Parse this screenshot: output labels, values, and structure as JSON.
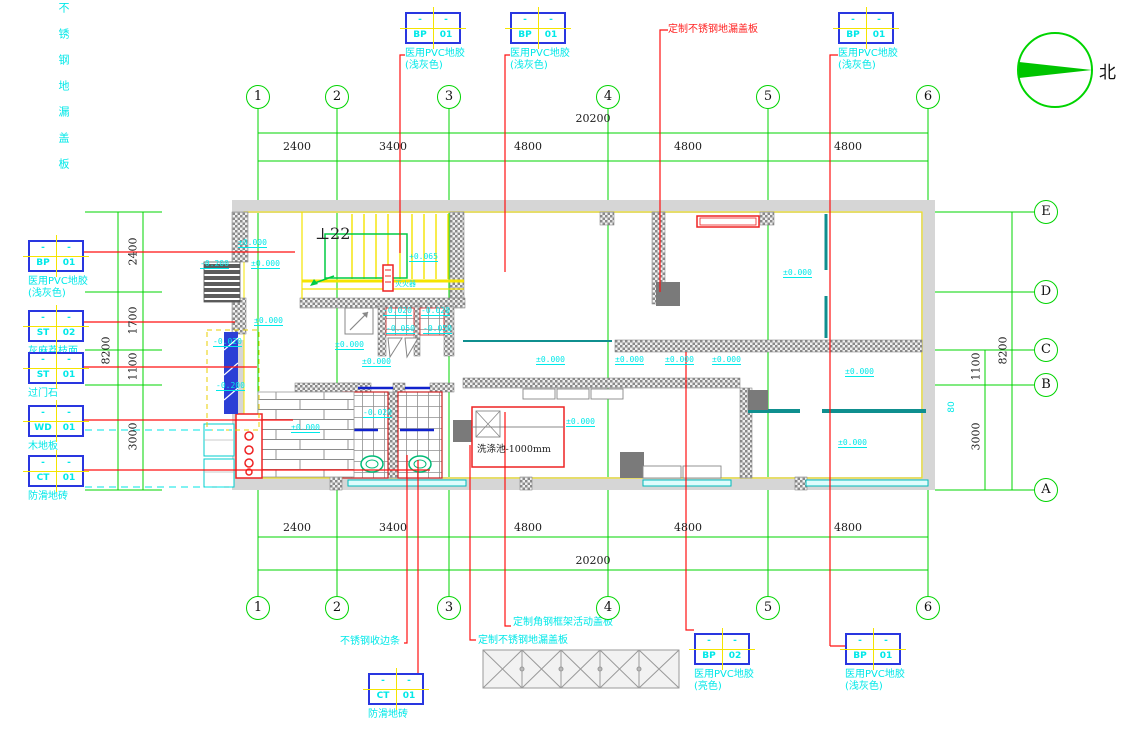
{
  "corner_note": "不锈钢地漏盖板",
  "north_label": "北",
  "grid": {
    "cols": [
      "1",
      "2",
      "3",
      "4",
      "5",
      "6"
    ],
    "rows": [
      "E",
      "D",
      "C",
      "B",
      "A"
    ]
  },
  "dims": {
    "overall_width": "20200",
    "top": [
      "2400",
      "3400",
      "4800",
      "4800",
      "4800"
    ],
    "bottom": [
      "2400",
      "3400",
      "4800",
      "4800",
      "4800"
    ],
    "overall_height": "8200",
    "left": [
      "2400",
      "1700",
      "1100",
      "3000"
    ],
    "right": [
      "1100",
      "3000"
    ],
    "right_small": "80"
  },
  "tags": {
    "dash": "-",
    "top1": {
      "code": "BP",
      "num": "01",
      "desc1": "医用PVC地胶",
      "desc2": "(浅灰色)"
    },
    "top2": {
      "code": "BP",
      "num": "01",
      "desc1": "医用PVC地胶",
      "desc2": "(浅灰色)"
    },
    "top3": {
      "code": "BP",
      "num": "01",
      "desc1": "医用PVC地胶",
      "desc2": "(浅灰色)"
    },
    "left_bp01": {
      "code": "BP",
      "num": "01",
      "desc1": "医用PVC地胶",
      "desc2": "(浅灰色)"
    },
    "left_st02": {
      "code": "ST",
      "num": "02",
      "desc1": "灰麻荔枝面",
      "desc2": ""
    },
    "left_st01": {
      "code": "ST",
      "num": "01",
      "desc1": "过门石",
      "desc2": ""
    },
    "left_wd01": {
      "code": "WD",
      "num": "01",
      "desc1": "木地板",
      "desc2": ""
    },
    "left_ct01": {
      "code": "CT",
      "num": "01",
      "desc1": "防滑地砖",
      "desc2": ""
    },
    "bottom_ct01": {
      "code": "CT",
      "num": "01",
      "desc1": "防滑地砖",
      "desc2": ""
    },
    "bottom_bp02": {
      "code": "BP",
      "num": "02",
      "desc1": "医用PVC地胶",
      "desc2": "(亮色)"
    },
    "bottom_bp01": {
      "code": "BP",
      "num": "01",
      "desc1": "医用PVC地胶",
      "desc2": "(浅灰色)"
    }
  },
  "notes": {
    "top_drain": "定制不锈钢地漏盖板",
    "edge_strip": "不锈钢收边条",
    "bottom_drain": "定制不锈钢地漏盖板",
    "frame_cover": "定制角钢框架活动盖板"
  },
  "plan_texts": {
    "stair": "⊥22",
    "sink": "洗涤池-1000mm",
    "extinguisher": "灭火器"
  },
  "elevations": [
    "±0.000",
    "-0.200",
    "±0.000",
    "±0.000",
    "-0.020",
    "-0.200",
    "±0.000",
    "+0.065",
    "-0.020",
    "-0.020",
    "-0.050",
    "-0.050",
    "±0.000",
    "±0.000",
    "±0.000",
    "±0.000",
    "±0.000",
    "±0.000",
    "±0.000",
    "±0.000",
    "±0.000",
    "-0.020",
    "±0.000"
  ],
  "colors": {
    "grid_green": "#00d400",
    "leader_red": "#ff1111",
    "annotation_cyan": "#00e8e8",
    "tag_border_blue": "#2936e0",
    "wall_gray": "#d6d6d6",
    "highlight_yellow": "#f5e400",
    "teal_wall": "#0f8f8f"
  }
}
